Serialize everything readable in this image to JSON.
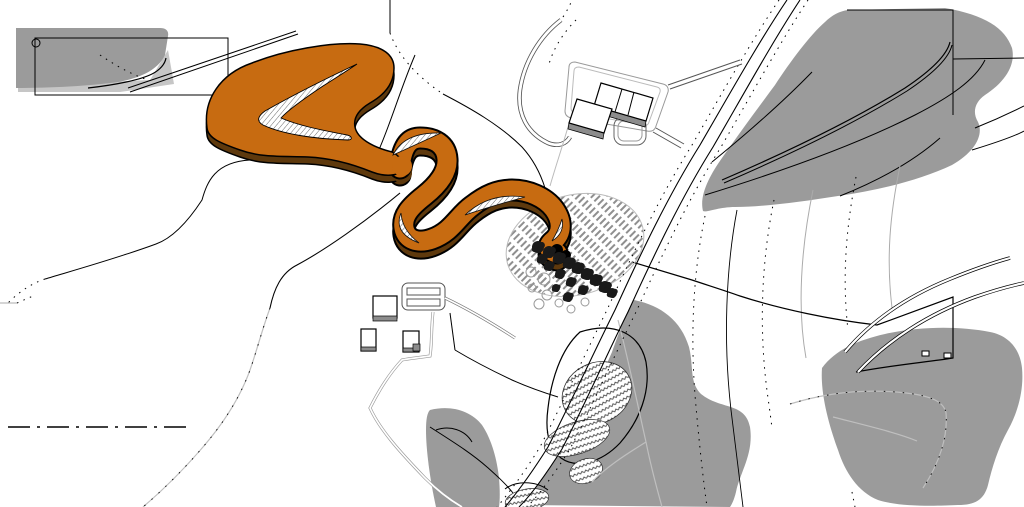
{
  "title": "Site plan drawing — serpentine landform with road, woods and buildings",
  "colors": {
    "canvas": "#FFFFFF",
    "ink": "#000000",
    "ribbon_orange": "#C76B11",
    "ribbon_shadow": "#5E390D",
    "vegetation_gray": "#9B9B9B",
    "vegetation_light": "#C6C6C6",
    "building_fill": "#FFFFFF",
    "building_shade": "#8C8C8C",
    "stripe_gray": "#8F8F8F",
    "light_line": "#ABABAB",
    "hatch_line": "#444444"
  },
  "trees": {
    "dark": [
      [
        538,
        247,
        6
      ],
      [
        549,
        252,
        6
      ],
      [
        559,
        258,
        6
      ],
      [
        569,
        263,
        6
      ],
      [
        578,
        268,
        6
      ],
      [
        587,
        274,
        6
      ],
      [
        596,
        280,
        6
      ],
      [
        605,
        287,
        6
      ],
      [
        612,
        293,
        5
      ],
      [
        549,
        266,
        5
      ],
      [
        560,
        274,
        5
      ],
      [
        571,
        282,
        5
      ],
      [
        583,
        290,
        5
      ],
      [
        556,
        288,
        4
      ],
      [
        568,
        297,
        5
      ],
      [
        542,
        259,
        5
      ]
    ],
    "light": [
      [
        531,
        272,
        5
      ],
      [
        544,
        279,
        6
      ],
      [
        532,
        288,
        4
      ],
      [
        547,
        295,
        5
      ],
      [
        539,
        304,
        5
      ],
      [
        559,
        303,
        4
      ],
      [
        571,
        309,
        4
      ],
      [
        585,
        302,
        4
      ]
    ]
  },
  "survey_marks": [
    [
      944,
      353
    ],
    [
      922,
      351
    ]
  ]
}
